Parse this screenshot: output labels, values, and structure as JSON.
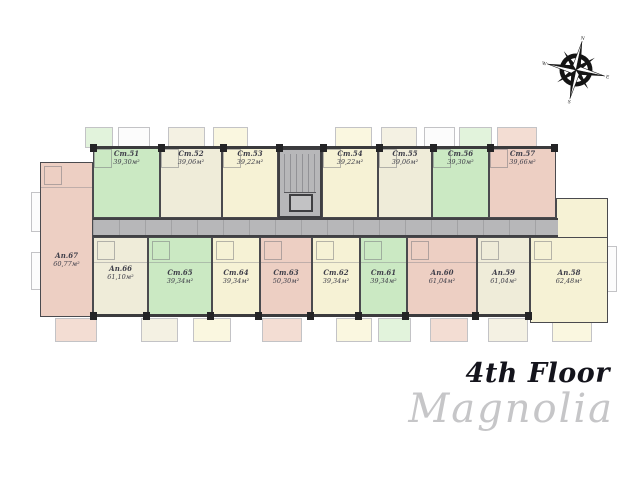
{
  "page": {
    "title": "4th Floor",
    "brand": "Magnolia"
  },
  "compass": {
    "n": "N",
    "e": "E",
    "s": "S",
    "w": "W"
  },
  "palette": {
    "green": "#cbe9c3",
    "cream": "#efecd9",
    "yellow": "#f6f2d5",
    "pink": "#edcfc3",
    "corridor": "#b7b7b9",
    "wall": "#3b3b3d"
  },
  "plan": {
    "top_units": [
      {
        "id": "Ст.51",
        "area": "39,30м²",
        "color": "green"
      },
      {
        "id": "Ст.52",
        "area": "39,06м²",
        "color": "cream"
      },
      {
        "id": "Ст.53",
        "area": "39,22м²",
        "color": "yellow"
      },
      {
        "id": "Ст.54",
        "area": "39,22м²",
        "color": "yellow"
      },
      {
        "id": "Ст.55",
        "area": "39,06м²",
        "color": "cream"
      },
      {
        "id": "Ст.56",
        "area": "39,30м²",
        "color": "green"
      },
      {
        "id": "Ст.57",
        "area": "39,66м²",
        "color": "pink"
      }
    ],
    "bottom_units": [
      {
        "id": "Ап.67",
        "area": "60,77м²",
        "color": "pink"
      },
      {
        "id": "Ап.66",
        "area": "61,10м²",
        "color": "cream"
      },
      {
        "id": "Ст.65",
        "area": "39,34м²",
        "color": "green"
      },
      {
        "id": "Ст.64",
        "area": "39,34м²",
        "color": "yellow"
      },
      {
        "id": "Ст.63",
        "area": "50,30м²",
        "color": "pink"
      },
      {
        "id": "Ст.62",
        "area": "39,34м²",
        "color": "yellow"
      },
      {
        "id": "Ст.61",
        "area": "39,34м²",
        "color": "green"
      },
      {
        "id": "Ап.60",
        "area": "61,04м²",
        "color": "pink"
      },
      {
        "id": "Ап.59",
        "area": "61,04м²",
        "color": "cream"
      },
      {
        "id": "Ап.58",
        "area": "62,48м²",
        "color": "yellow"
      }
    ]
  }
}
